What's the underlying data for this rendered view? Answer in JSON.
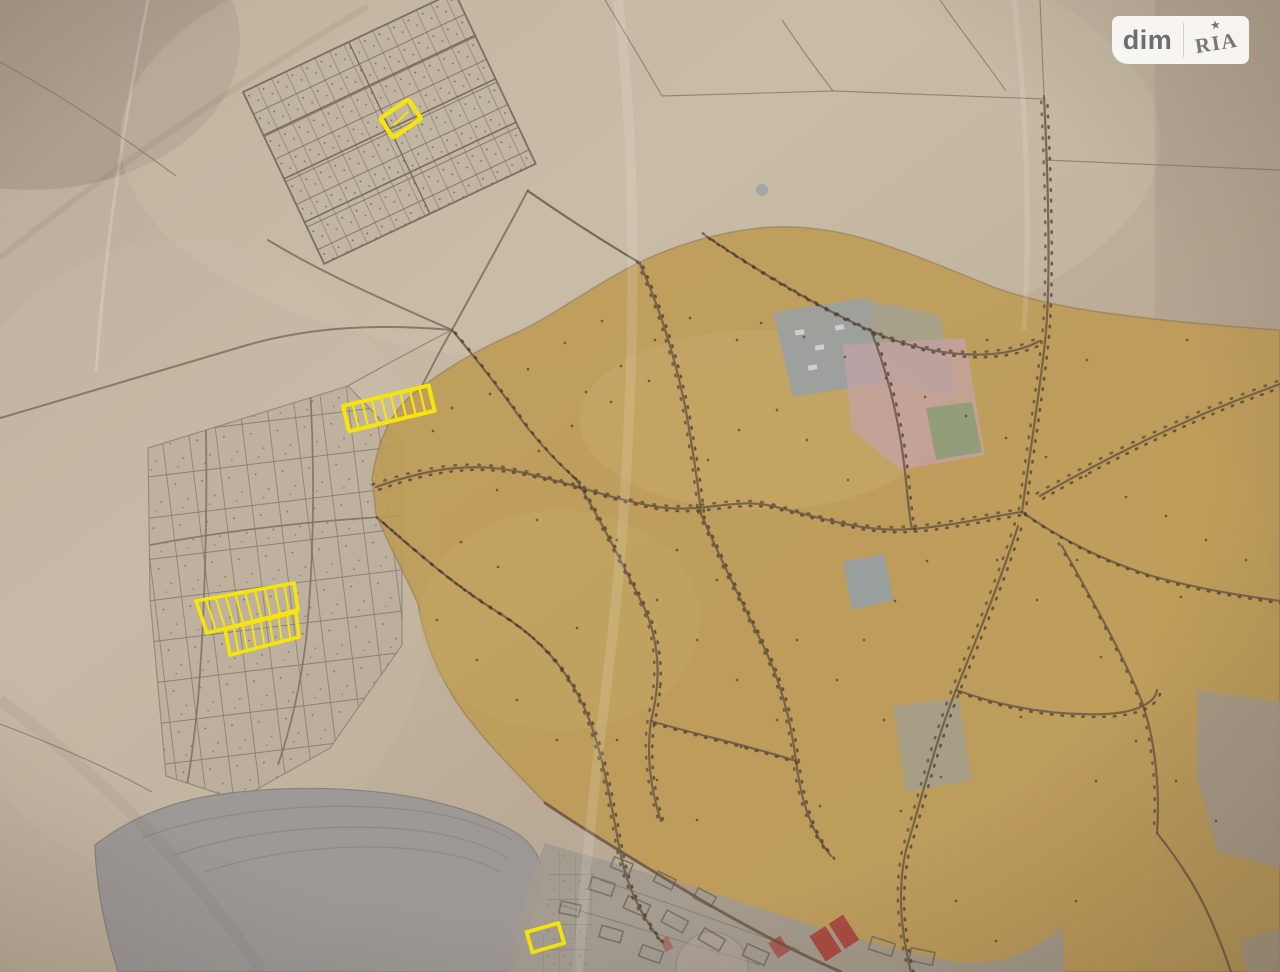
{
  "watermark": {
    "brand_left": "dim",
    "brand_right": "RIA",
    "star": "★"
  },
  "map": {
    "description": "Photo of a hand-drawn cadastral master plan; offered land plots are outlined in yellow",
    "highlighted_plots": [
      {
        "id": "north-single-plot",
        "cells": 1
      },
      {
        "id": "upper-west-strip",
        "cells": 9
      },
      {
        "id": "west-double-row-block",
        "cells": 17
      },
      {
        "id": "south-single-plot",
        "cells": 1
      }
    ],
    "colors": {
      "paper": "#b3a795",
      "paper_light": "#cdc1ab",
      "paper_dark": "#857867",
      "village": "#bf9c55",
      "village_edge": "#8a7347",
      "road": "#6a5643",
      "house_dot": "#46382a",
      "grid_line": "#847a6b",
      "grid_road": "#7c7263",
      "pond": "#9c9897",
      "pond_edge": "#85817e",
      "gray_zone": "#a29a90",
      "block_line": "#6f675e",
      "red_building": "#a84b41",
      "pink_zone": "#c4a1a6",
      "industrial_block": "#96a0a6",
      "green_patch": "#7d9b6e",
      "water_patch": "#8fa0ad",
      "highlight": "#f6e50a",
      "logo_bg": "#fbfaf7",
      "logo_dim": "#6c6c6c",
      "logo_ria": "#7b756d",
      "logo_divider": "#d6d3cd"
    }
  }
}
